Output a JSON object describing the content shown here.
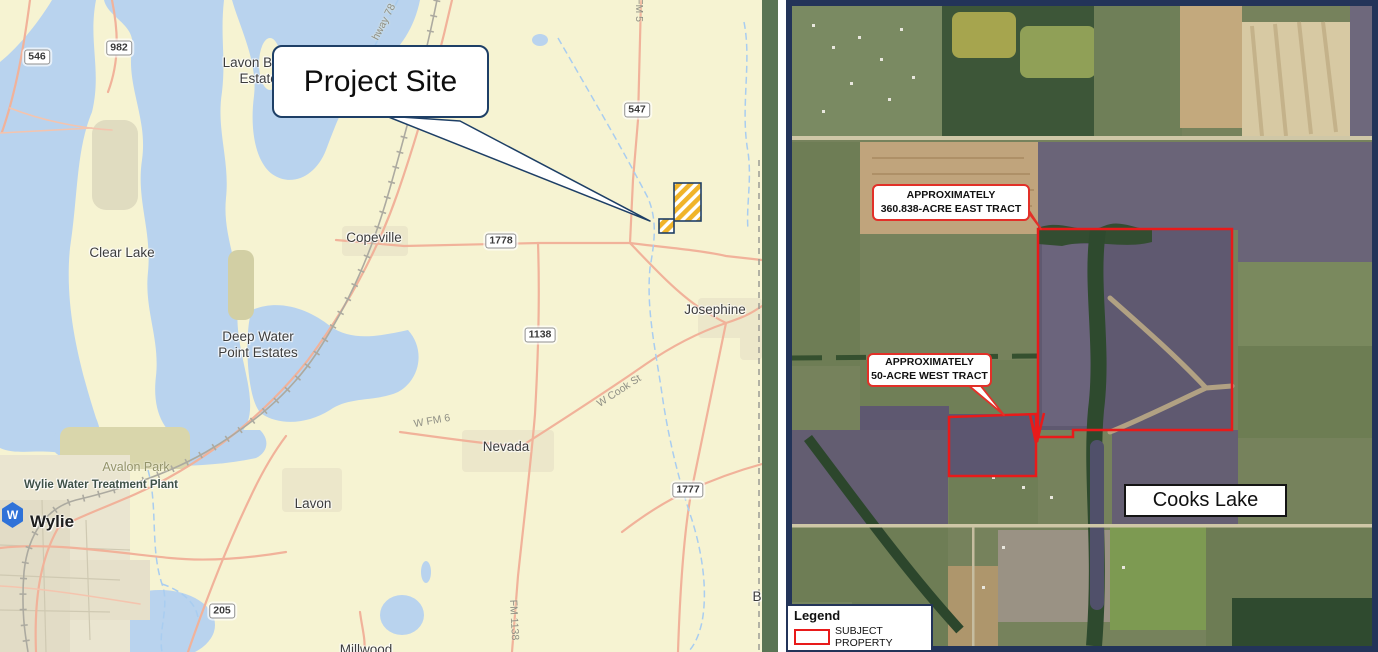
{
  "colors": {
    "land": "#f6f3d2",
    "water": "#b9d3ee",
    "road_salmon": "#f1b29a",
    "railroad_gray": "#acaaa0",
    "navy": "#1e3f66",
    "boundary_red": "#e81a1a",
    "site_hatch_yellow": "#f0b429",
    "right_map_border": "#233459",
    "divider_green": "#5a7454"
  },
  "left_map": {
    "callout": {
      "label": "Project Site"
    },
    "place_labels": [
      {
        "text": "Lavon Beach\nEstates",
        "x": 262,
        "y": 71,
        "cls": "city"
      },
      {
        "text": "Clear Lake",
        "x": 122,
        "y": 253,
        "cls": "city"
      },
      {
        "text": "Copeville",
        "x": 374,
        "y": 238,
        "cls": "city"
      },
      {
        "text": "Josephine",
        "x": 715,
        "y": 310,
        "cls": "city"
      },
      {
        "text": "Deep Water\nPoint Estates",
        "x": 258,
        "y": 345,
        "cls": "city"
      },
      {
        "text": "Nevada",
        "x": 506,
        "y": 447,
        "cls": "city"
      },
      {
        "text": "Lavon",
        "x": 313,
        "y": 504,
        "cls": "city"
      },
      {
        "text": "Wylie",
        "x": 52,
        "y": 522,
        "cls": "city-major"
      },
      {
        "text": "Avalon Park",
        "x": 136,
        "y": 467,
        "cls": "park"
      },
      {
        "text": "Wylie Water Treatment Plant",
        "x": 101,
        "y": 485,
        "cls": "plant"
      },
      {
        "text": "Millwood",
        "x": 366,
        "y": 650,
        "cls": "city"
      },
      {
        "text": "B",
        "x": 757,
        "y": 597,
        "cls": "city"
      }
    ],
    "route_shields": [
      {
        "text": "546",
        "x": 37,
        "y": 57
      },
      {
        "text": "982",
        "x": 119,
        "y": 48
      },
      {
        "text": "547",
        "x": 637,
        "y": 110
      },
      {
        "text": "1778",
        "x": 501,
        "y": 241
      },
      {
        "text": "1138",
        "x": 540,
        "y": 335
      },
      {
        "text": "1777",
        "x": 688,
        "y": 490
      },
      {
        "text": "205",
        "x": 222,
        "y": 611
      }
    ],
    "road_labels": [
      {
        "text": "hway 78",
        "x": 384,
        "y": 22,
        "rot": -63
      },
      {
        "text": "FM 5",
        "x": 639,
        "y": 10,
        "rot": 90
      },
      {
        "text": "W Cook St",
        "x": 619,
        "y": 391,
        "rot": -33
      },
      {
        "text": "W FM 6",
        "x": 432,
        "y": 421,
        "rot": -10
      },
      {
        "text": "FM 1138",
        "x": 514,
        "y": 620,
        "rot": 87
      }
    ],
    "city_marker": {
      "letter": "W"
    }
  },
  "right_map": {
    "tract_callouts": [
      {
        "line1": "APPROXIMATELY",
        "line2": "360.838-ACRE EAST TRACT",
        "x": 872,
        "y": 184,
        "w": 158,
        "h": 37
      },
      {
        "line1": "APPROXIMATELY",
        "line2": "50-ACRE WEST TRACT",
        "x": 867,
        "y": 353,
        "w": 125,
        "h": 34
      }
    ],
    "lake_label": {
      "text": "Cooks Lake",
      "x": 1124,
      "y": 484,
      "w": 163,
      "h": 33
    },
    "legend": {
      "title": "Legend",
      "items": [
        {
          "label": "SUBJECT PROPERTY"
        }
      ]
    }
  }
}
